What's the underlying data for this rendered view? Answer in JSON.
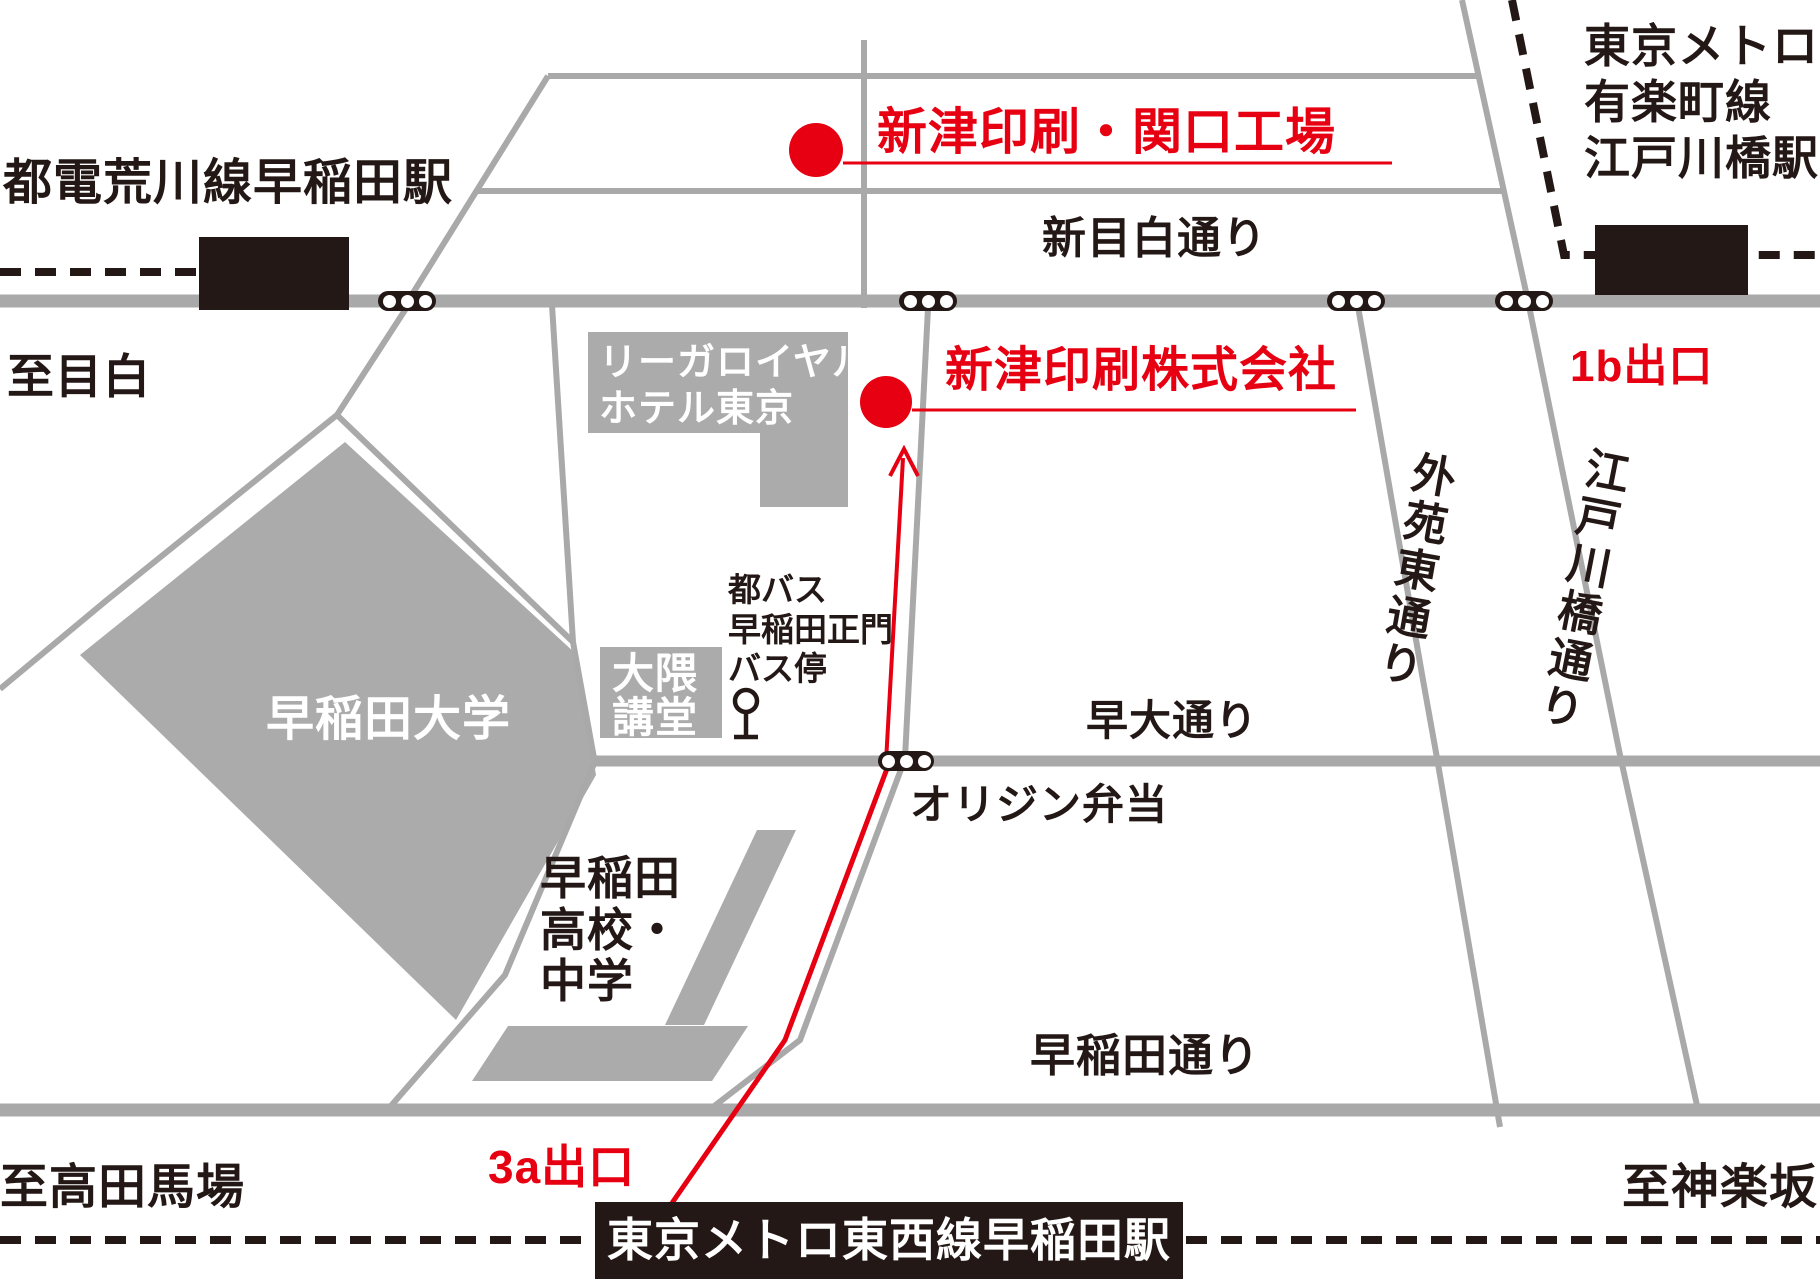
{
  "map_title": "新津印刷株式会社 アクセスマップ",
  "colors": {
    "accent_red": "#e60012",
    "road_gray": "#a9a9a9",
    "fill_gray": "#ababab",
    "ink_black": "#231815"
  },
  "stations": {
    "toden": {
      "label": "都電荒川線早稲田駅"
    },
    "yurakucho": {
      "label": "東京メトロ\n有楽町線\n江戸川橋駅"
    },
    "tozai": {
      "label": "東京メトロ東西線早稲田駅"
    }
  },
  "destinations": {
    "sekiguchi_plant": {
      "label": "新津印刷・関口工場"
    },
    "head_office": {
      "label": "新津印刷株式会社"
    }
  },
  "exits": {
    "exit_1b": {
      "label": "1b出口"
    },
    "exit_3a": {
      "label": "3a出口"
    }
  },
  "roads": {
    "shin_mejiro_dori": {
      "label": "新目白通り"
    },
    "sodai_dori": {
      "label": "早大通り"
    },
    "waseda_dori": {
      "label": "早稲田通り"
    },
    "gaien_higashi_dori": {
      "label": "外苑東通り"
    },
    "edogawabashi_dori": {
      "label": "江戸川橋通り"
    }
  },
  "directions": {
    "to_mejiro": {
      "label": "至目白"
    },
    "to_takadanobaba": {
      "label": "至高田馬場"
    },
    "to_kagurazaka": {
      "label": "至神楽坂"
    }
  },
  "places": {
    "rihga_hotel": {
      "label": "リーガロイヤル\nホテル東京"
    },
    "okuma_auditorium": {
      "label": "大隈\n講堂"
    },
    "bus_stop": {
      "label": "都バス\n早稲田正門\nバス停"
    },
    "waseda_university": {
      "label": "早稲田大学"
    },
    "waseda_school": {
      "label": "早稲田\n高校・\n中学"
    },
    "origin_bento": {
      "label": "オリジン弁当"
    }
  },
  "icons": {
    "traffic_light": "signal with three lamps",
    "bus_stop_pole": "bus stop pole",
    "station_block": "filled station rectangle",
    "subway_dashed_line": "dashed subway line",
    "route_arrow": "red walking route with arrow"
  }
}
